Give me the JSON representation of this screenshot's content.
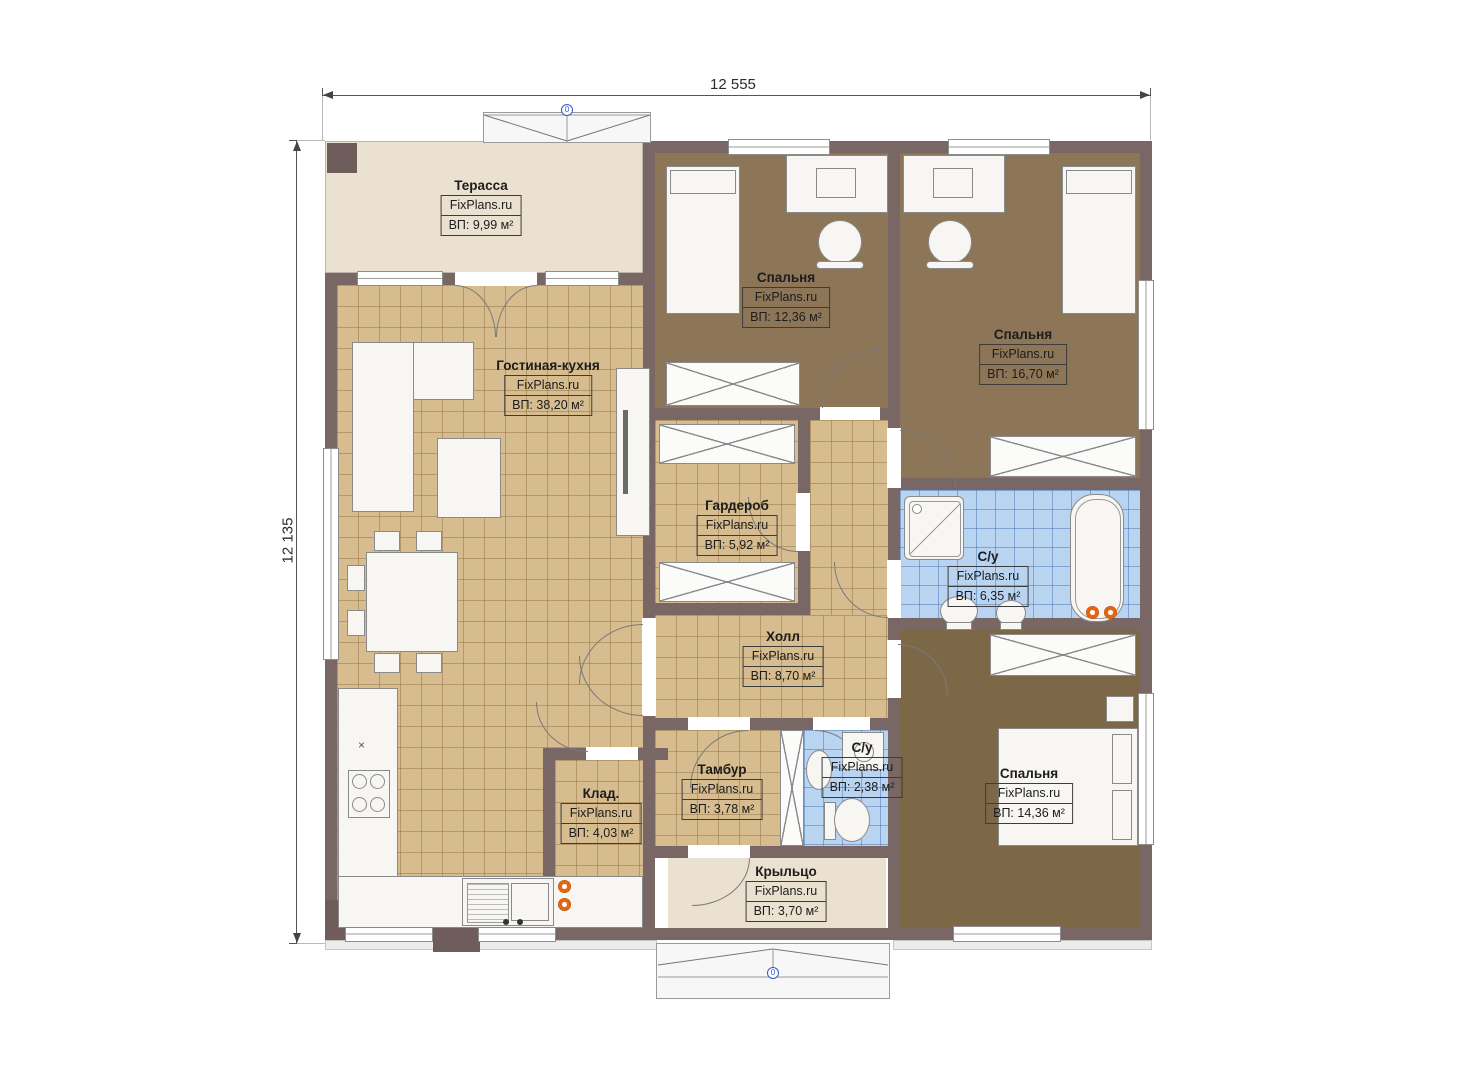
{
  "plan": {
    "brand": "FixPlans.ru",
    "dimensions": {
      "width": "12 555",
      "height": "12 135"
    },
    "level_markers": {
      "top": "0",
      "bottom": "0"
    },
    "rooms": [
      {
        "name": "Терасса",
        "brand": "FixPlans.ru",
        "area": "ВП: 9,99 м²"
      },
      {
        "name": "Спальня",
        "brand": "FixPlans.ru",
        "area": "ВП: 12,36 м²"
      },
      {
        "name": "Спальня",
        "brand": "FixPlans.ru",
        "area": "ВП: 16,70 м²"
      },
      {
        "name": "Гостиная-кухня",
        "brand": "FixPlans.ru",
        "area": "ВП: 38,20 м²"
      },
      {
        "name": "Гардероб",
        "brand": "FixPlans.ru",
        "area": "ВП: 5,92 м²"
      },
      {
        "name": "С/у",
        "brand": "FixPlans.ru",
        "area": "ВП: 6,35 м²"
      },
      {
        "name": "Холл",
        "brand": "FixPlans.ru",
        "area": "ВП: 8,70 м²"
      },
      {
        "name": "Тамбур",
        "brand": "FixPlans.ru",
        "area": "ВП: 3,78 м²"
      },
      {
        "name": "С/у",
        "brand": "FixPlans.ru",
        "area": "ВП: 2,38 м²"
      },
      {
        "name": "Клад.",
        "brand": "FixPlans.ru",
        "area": "ВП: 4,03 м²"
      },
      {
        "name": "Спальня",
        "brand": "FixPlans.ru",
        "area": "ВП: 14,36 м²"
      },
      {
        "name": "Крыльцо",
        "brand": "FixPlans.ru",
        "area": "ВП: 3,70 м²"
      }
    ],
    "colors": {
      "wall": "#786765",
      "tile_floor": "#d6bc8f",
      "carpet": "#8d7658",
      "bath_tile": "#b9d4f0",
      "deck": "#ebe1d1",
      "radiator_orange": "#e8650f",
      "marker_blue": "#3558c8"
    }
  }
}
